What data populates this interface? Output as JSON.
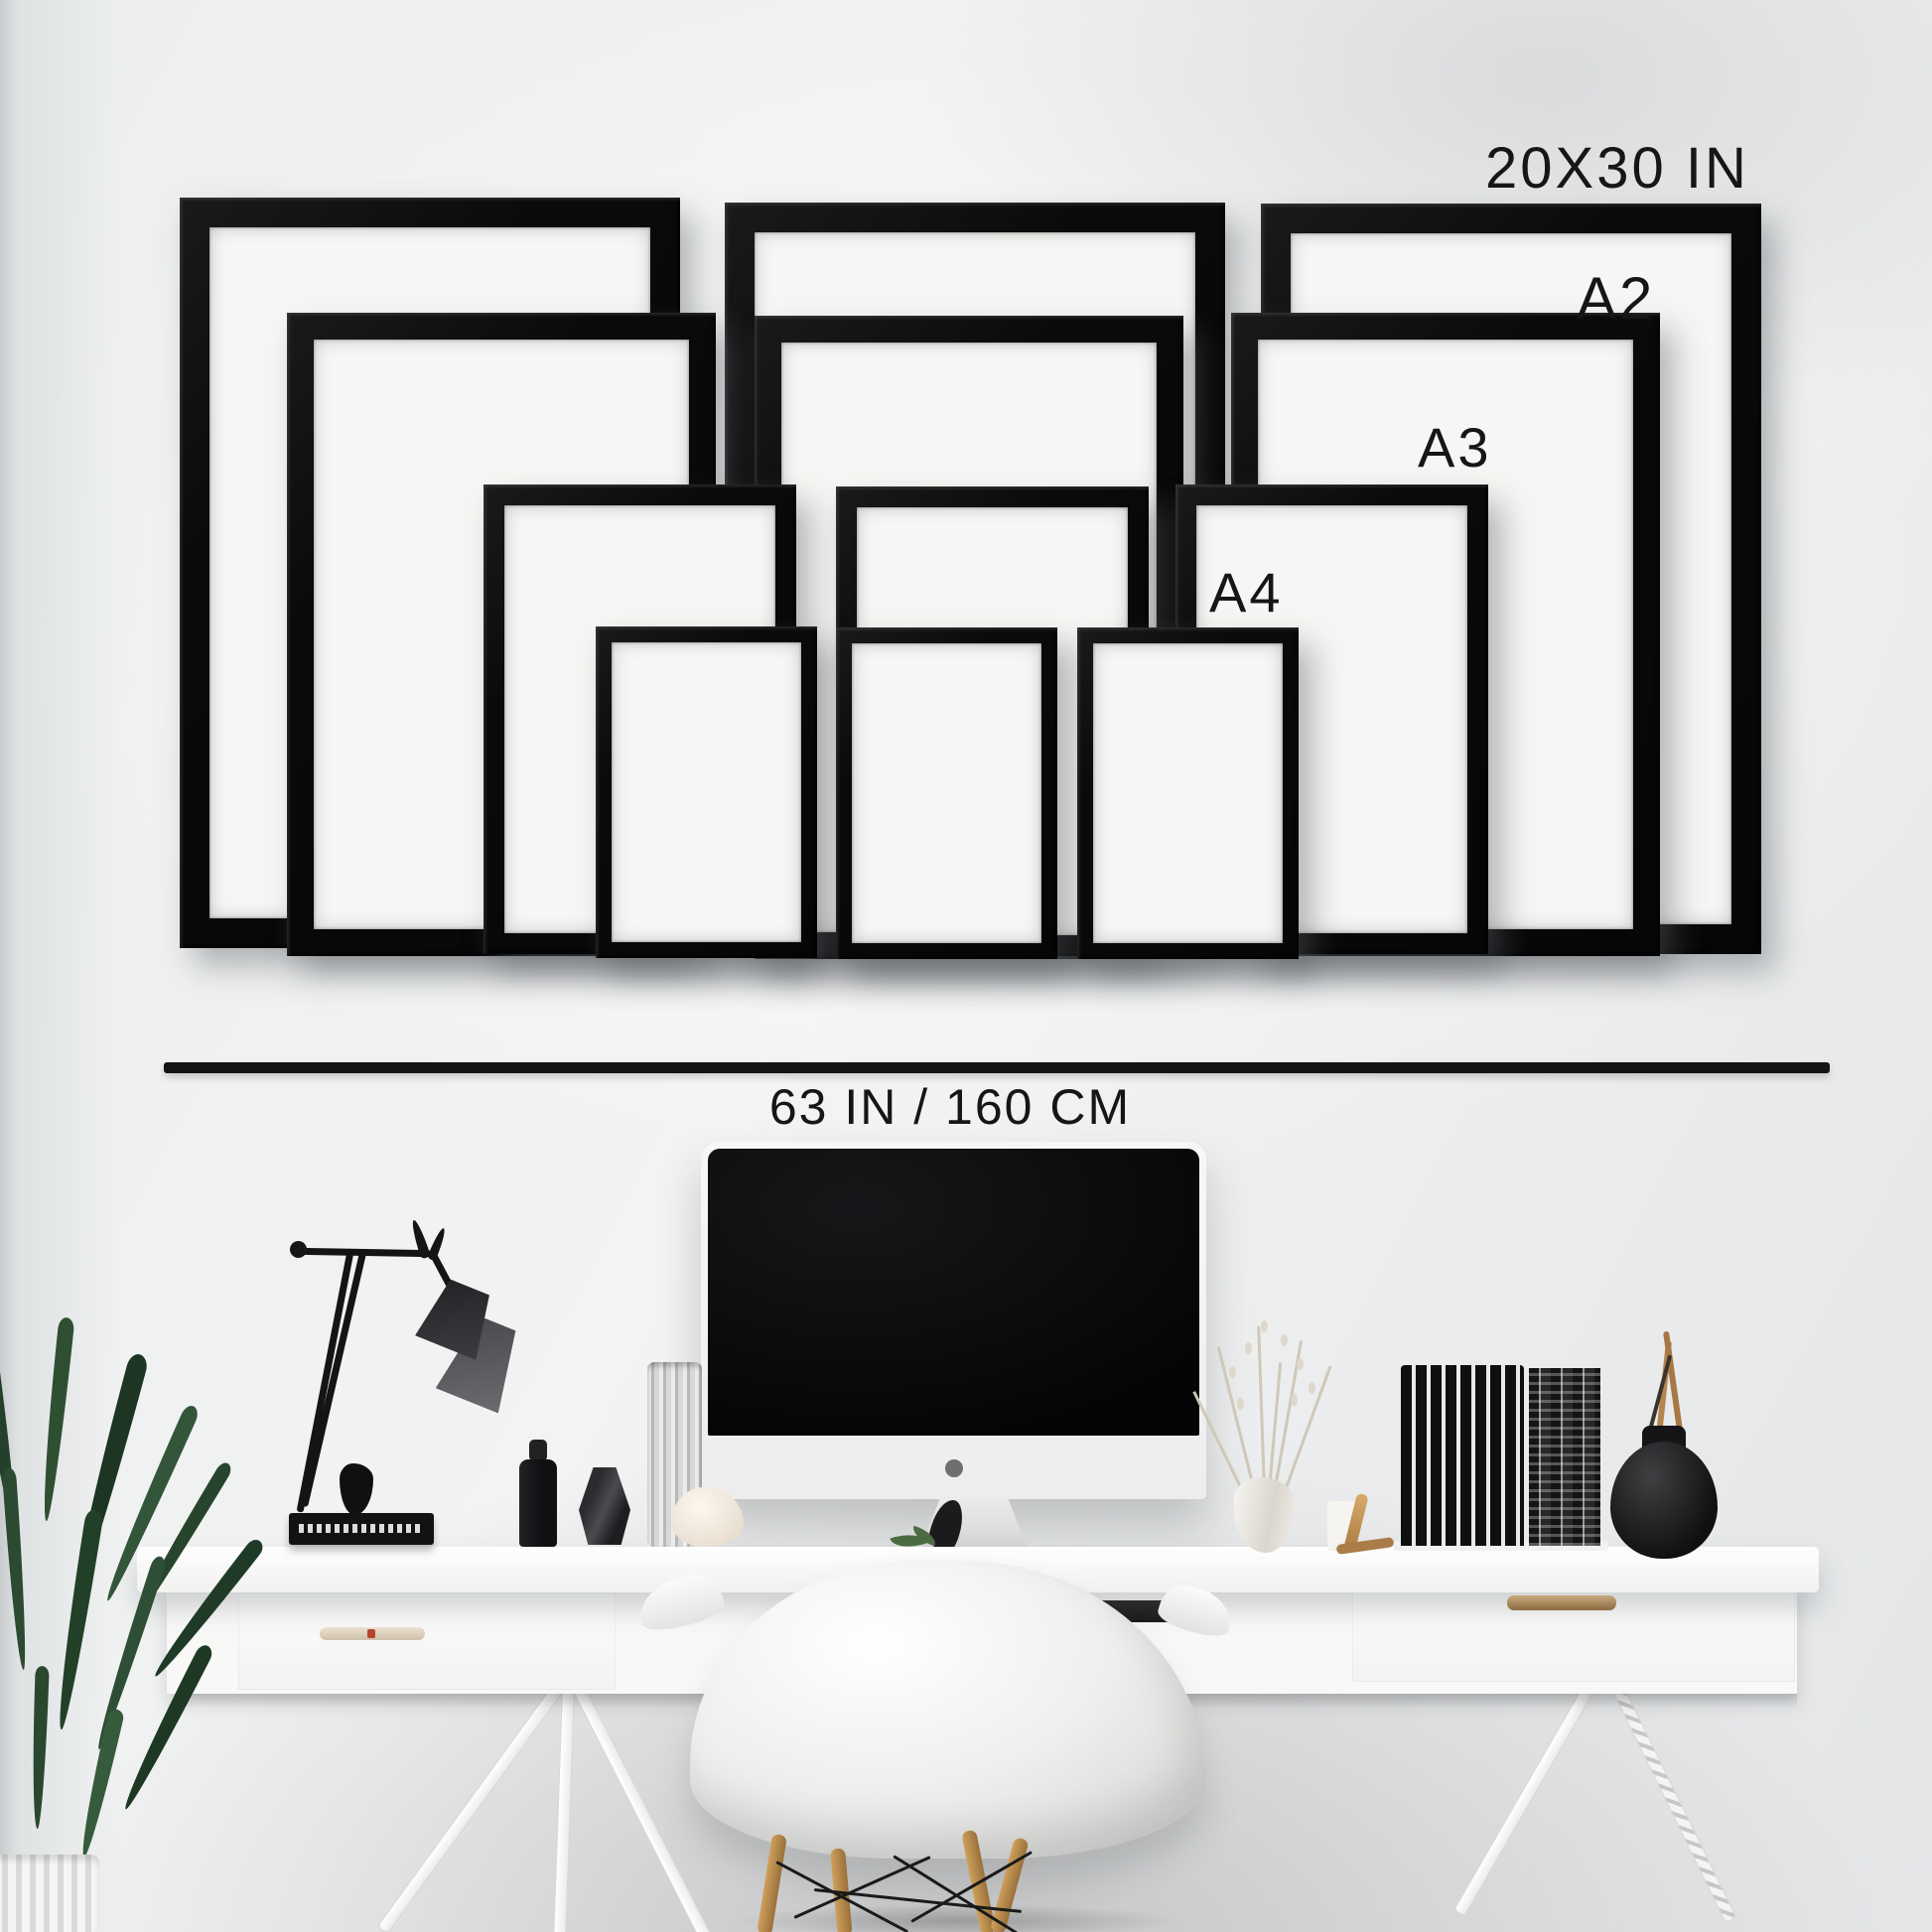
{
  "scene": {
    "type": "picture-frame-size-guide-mockup",
    "labels": {
      "size_20x30": "20X30 IN",
      "size_a2": "A2",
      "size_a3": "A3",
      "size_a4": "A4",
      "width": "63 IN / 160 CM"
    },
    "frames": [
      {
        "size": "20x30 in",
        "column": "left"
      },
      {
        "size": "20x30 in",
        "column": "middle"
      },
      {
        "size": "20x30 in",
        "column": "right"
      },
      {
        "size": "A2",
        "column": "left"
      },
      {
        "size": "A2",
        "column": "middle"
      },
      {
        "size": "A2",
        "column": "right"
      },
      {
        "size": "A3",
        "column": "left"
      },
      {
        "size": "A3",
        "column": "middle"
      },
      {
        "size": "A3",
        "column": "right"
      },
      {
        "size": "A4",
        "column": "left"
      },
      {
        "size": "A4",
        "column": "middle"
      },
      {
        "size": "A4",
        "column": "right"
      }
    ],
    "colors": {
      "frame_black": "#0e0e0e",
      "wall_gray": "#eef0f1",
      "annotation_text": "#161616",
      "desk_white": "#f8f8f7",
      "chair_wood": "#b07a3a",
      "plant_green": "#2e4a30"
    }
  }
}
